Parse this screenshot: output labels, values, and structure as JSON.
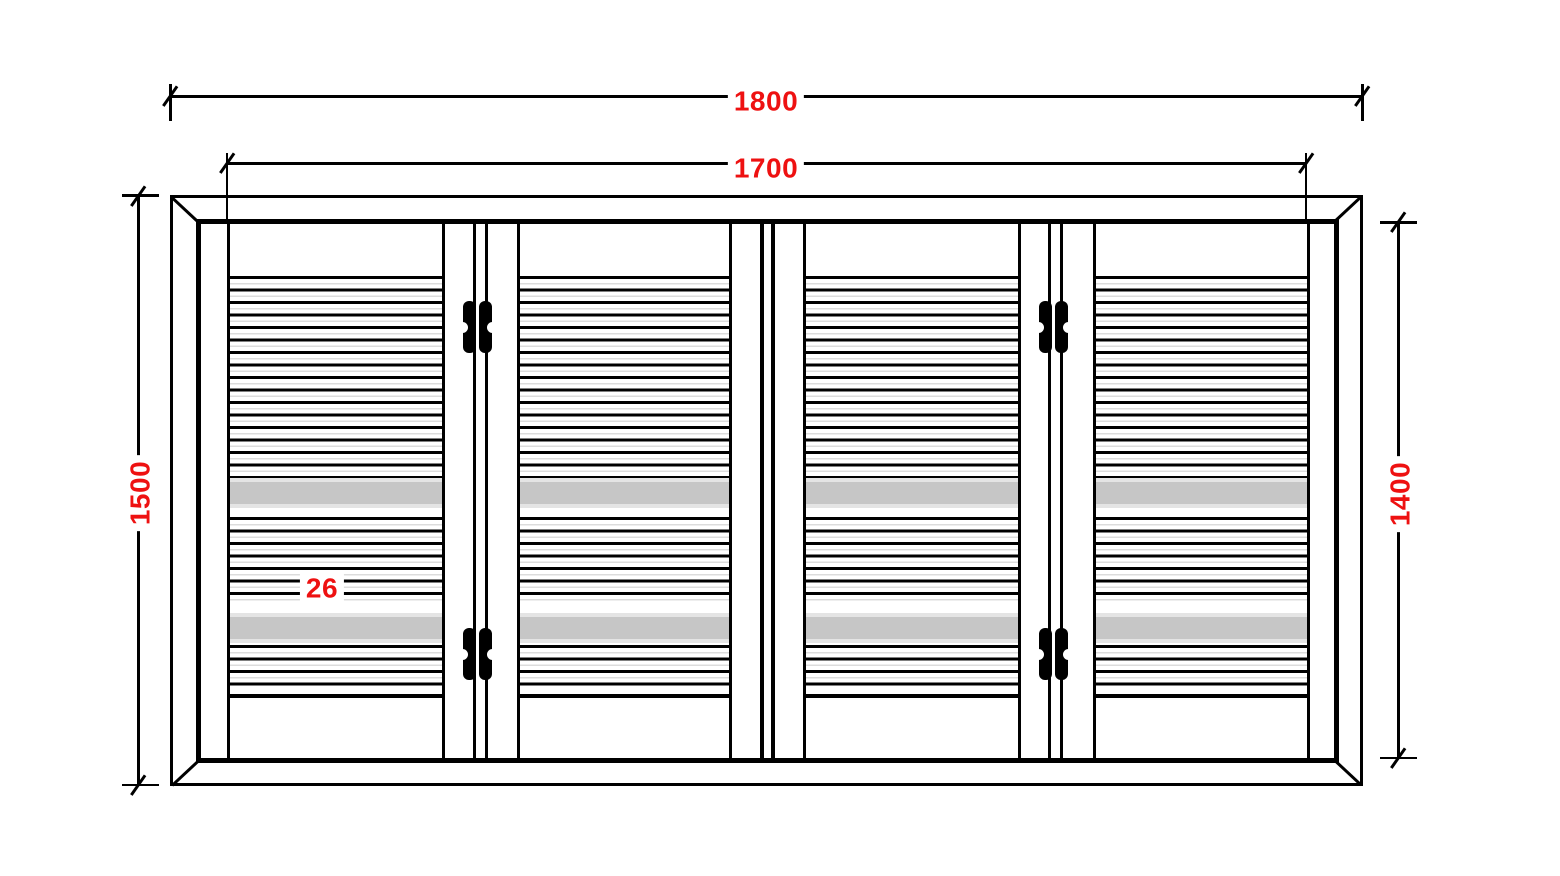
{
  "drawing": {
    "dimensions": {
      "overall_width": "1800",
      "inner_width": "1700",
      "overall_height": "1500",
      "inner_height": "1400",
      "detail": "26"
    },
    "panels": {
      "count": 4,
      "hinge_count": 4
    },
    "icons": {
      "hinge": "hinge-icon"
    },
    "colors": {
      "ink": "#000000",
      "red": "#ee1111",
      "band": "#c6c6c6",
      "band-edge": "#e4e4e4",
      "bg": "#ffffff"
    }
  }
}
